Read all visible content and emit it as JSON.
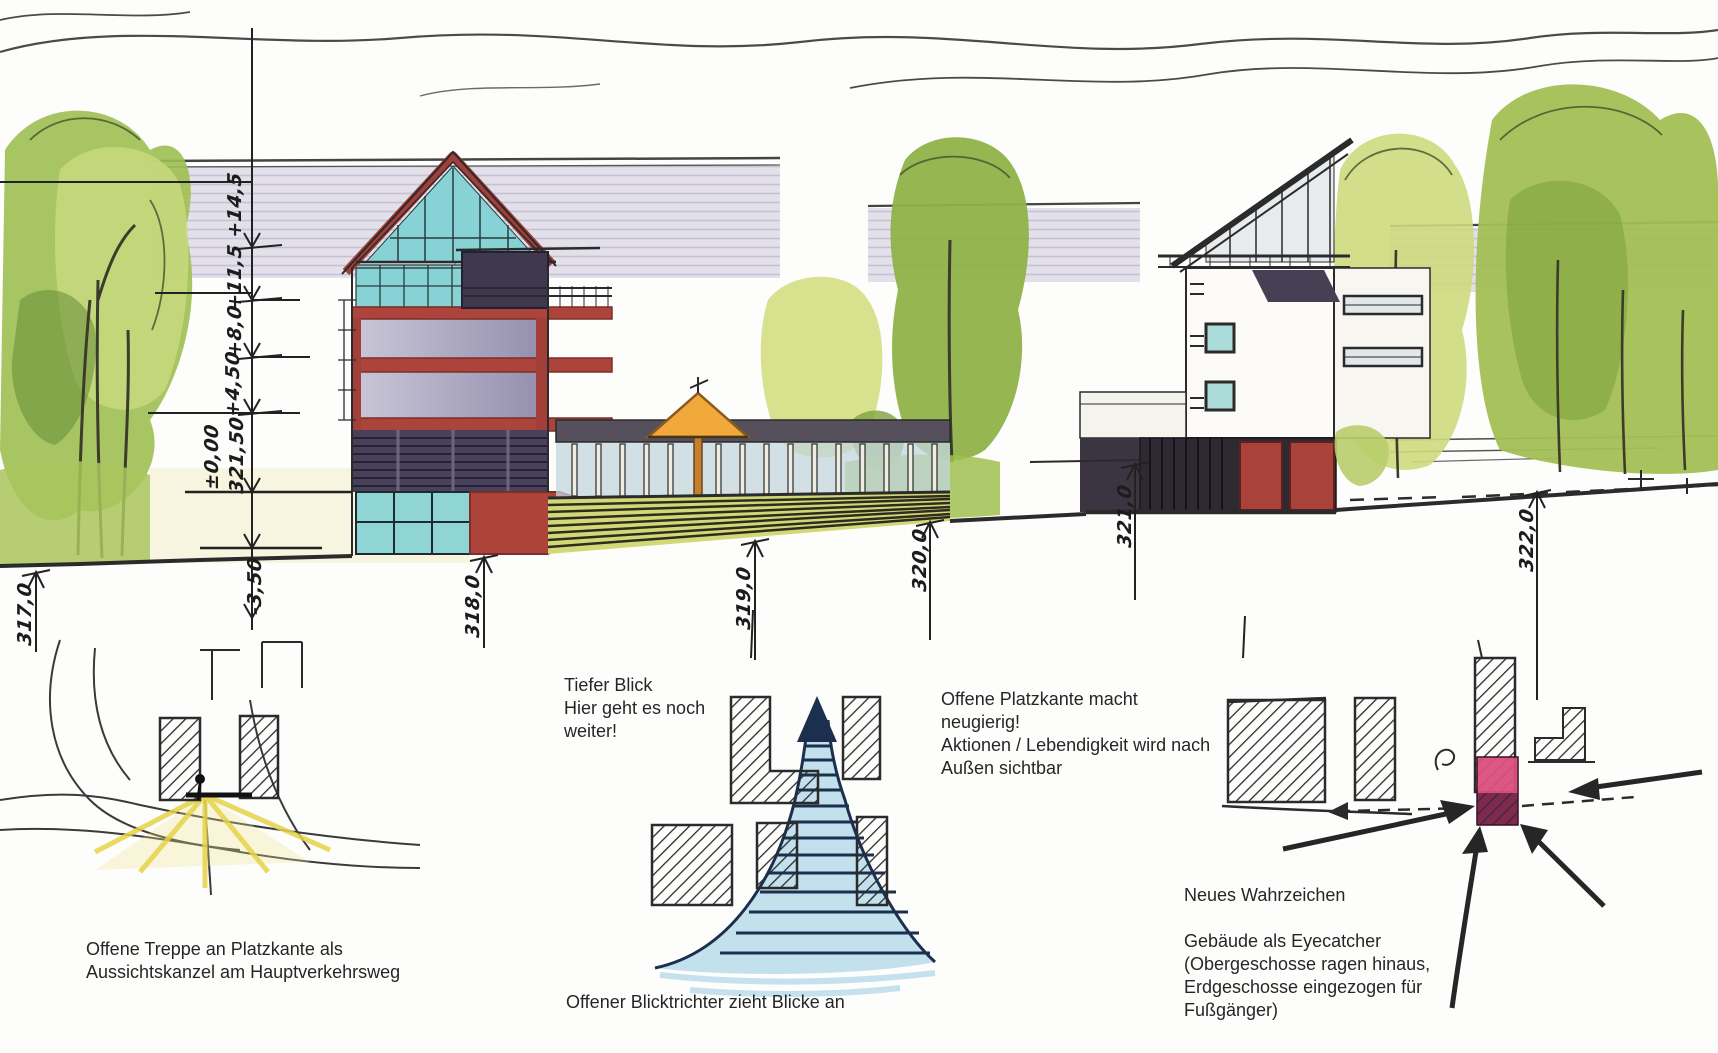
{
  "elevation": {
    "height_labels": [
      "+14,5",
      "+11,5",
      "+8,0",
      "+4,50",
      "±0,00",
      "321,50",
      "-3,50"
    ],
    "ground_labels": [
      "317,0",
      "318,0",
      "319,0",
      "320,0",
      "321,0",
      "322,0"
    ]
  },
  "annotations": {
    "left_sketch": "Offene Treppe an Platzkante als\nAussichtskanzel am Hauptverkehrsweg",
    "center_top": "Tiefer Blick\nHier geht es noch\nweiter!",
    "center_bottom": "Offener Blicktrichter zieht Blicke an",
    "platzkante": "Offene Platzkante macht\nneugierig!\nAktionen / Lebendigkeit wird nach\nAußen sichtbar",
    "wahrzeichen_title": "Neues Wahrzeichen",
    "eyecatcher": "Gebäude als Eyecatcher\n(Obergeschosse ragen hinaus,\nErdgeschosse eingezogen für\nFußgänger)"
  },
  "colors": {
    "facade_red": "#ad443c",
    "glass_teal": "#86d2d4",
    "window_lavender": "#c6c2d6",
    "canopy_orange": "#f2a93b",
    "steps_yellow_green": "#d3d876",
    "foliage_green": "#a3bf55",
    "funnel_blue": "#b7dcea",
    "landmark_pink": "#d94f7e",
    "highlight_yellow": "#e6d348",
    "ink": "#2b2b2b"
  }
}
